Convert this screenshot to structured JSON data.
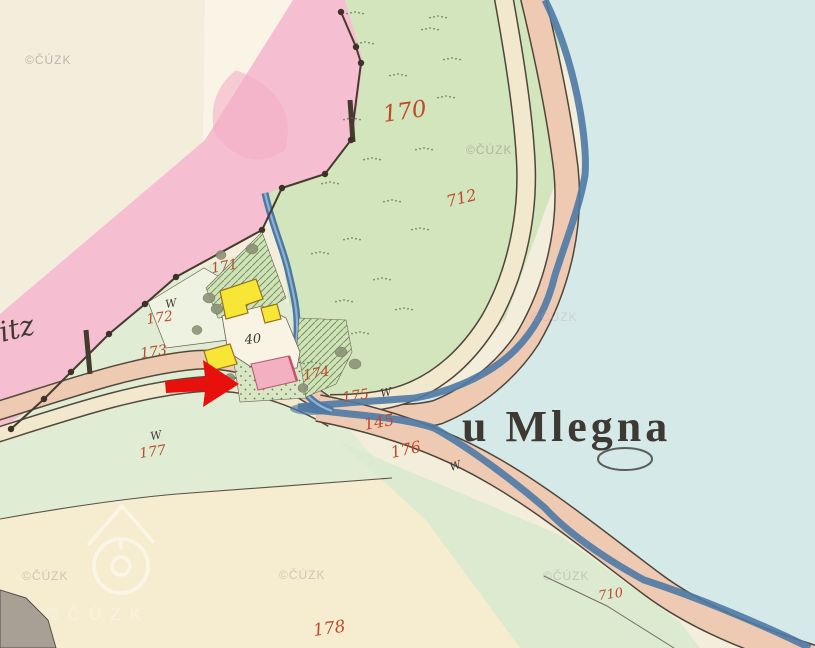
{
  "map": {
    "type": "historical-cadastral-map-scan",
    "place_label": "u Mlegna",
    "watermark_text": "©ČÚZK",
    "colors": {
      "paper": "#f3eedc",
      "pink": "#f6bfd1",
      "green": "#d2e5bc",
      "celadon": "#e0ecd3",
      "water": "#d5e9e8",
      "bank": "#4e7aa5",
      "road_tan": "#eecab3",
      "road_cream": "#f2e8ce",
      "wood": "#f8e636",
      "masonry": "#f3b0c0",
      "red": "#bd4b2b",
      "ink": "#3e3a33",
      "arrow": "#e8100c",
      "wmark": "#8c8c88"
    },
    "labels": [
      {
        "text": "170",
        "x": 384,
        "y": 122,
        "size": 23,
        "rot": -8,
        "color": "red",
        "cls": "red-lbl"
      },
      {
        "text": "712",
        "x": 448,
        "y": 207,
        "size": 16,
        "rot": -14,
        "color": "red",
        "cls": "red-lbl"
      },
      {
        "text": "171",
        "x": 212,
        "y": 273,
        "size": 14,
        "rot": -10,
        "color": "red",
        "cls": "red-lbl"
      },
      {
        "text": "172",
        "x": 147,
        "y": 324,
        "size": 14,
        "rot": -8,
        "color": "red",
        "cls": "red-lbl"
      },
      {
        "text": "173",
        "x": 141,
        "y": 358,
        "size": 14,
        "rot": -8,
        "color": "red",
        "cls": "red-lbl"
      },
      {
        "text": "174",
        "x": 304,
        "y": 380,
        "size": 14,
        "rot": -10,
        "color": "red",
        "cls": "red-lbl"
      },
      {
        "text": "175",
        "x": 343,
        "y": 402,
        "size": 14,
        "rot": -8,
        "color": "red",
        "cls": "red-lbl"
      },
      {
        "text": "145",
        "x": 365,
        "y": 430,
        "size": 16,
        "rot": -10,
        "color": "red",
        "cls": "red-lbl"
      },
      {
        "text": "176",
        "x": 392,
        "y": 458,
        "size": 16,
        "rot": -12,
        "color": "red",
        "cls": "red-lbl"
      },
      {
        "text": "177",
        "x": 140,
        "y": 458,
        "size": 14,
        "rot": -8,
        "color": "red",
        "cls": "red-lbl"
      },
      {
        "text": "178",
        "x": 314,
        "y": 636,
        "size": 17,
        "rot": -8,
        "color": "red",
        "cls": "red-lbl"
      },
      {
        "text": "710",
        "x": 599,
        "y": 600,
        "size": 13,
        "rot": -8,
        "color": "red",
        "cls": "red-lbl"
      },
      {
        "text": "40",
        "x": 245,
        "y": 344,
        "size": 13,
        "rot": -5,
        "color": "ink",
        "cls": "ink-script",
        "name": "house-number-40"
      },
      {
        "text": "itz",
        "x": 2,
        "y": 342,
        "size": 28,
        "rot": -14,
        "color": "ink",
        "cls": "ink-script",
        "name": "village-name-fragment"
      },
      {
        "text": "u Mlegna",
        "x": 462,
        "y": 441,
        "size": 44,
        "rot": 0,
        "color": "ink",
        "cls": "place",
        "name": "place-label-u-mlegna"
      },
      {
        "text": "W",
        "x": 166,
        "y": 308,
        "size": 11,
        "rot": -10,
        "color": "ink",
        "cls": "ink-script",
        "name": "meadow-mark"
      },
      {
        "text": "W",
        "x": 151,
        "y": 440,
        "size": 11,
        "rot": -10,
        "color": "ink",
        "cls": "ink-script",
        "name": "meadow-mark"
      },
      {
        "text": "W",
        "x": 381,
        "y": 397,
        "size": 11,
        "rot": -10,
        "color": "ink",
        "cls": "ink-script",
        "name": "meadow-mark"
      },
      {
        "text": "W",
        "x": 451,
        "y": 471,
        "size": 11,
        "rot": -18,
        "color": "ink",
        "cls": "ink-script",
        "name": "meadow-mark"
      }
    ],
    "watermarks": [
      {
        "x": 25,
        "y": 64,
        "opacity": 0.55
      },
      {
        "x": 466,
        "y": 154,
        "opacity": 0.5
      },
      {
        "x": 531,
        "y": 321,
        "opacity": 0.35,
        "tint": "#c79aab"
      },
      {
        "x": 22,
        "y": 580,
        "opacity": 0.4
      },
      {
        "x": 279,
        "y": 579,
        "opacity": 0.4
      },
      {
        "x": 543,
        "y": 580,
        "opacity": 0.35
      }
    ],
    "ghost_watermark": {
      "x": 46,
      "y": 620,
      "opacity": 0.3
    }
  }
}
